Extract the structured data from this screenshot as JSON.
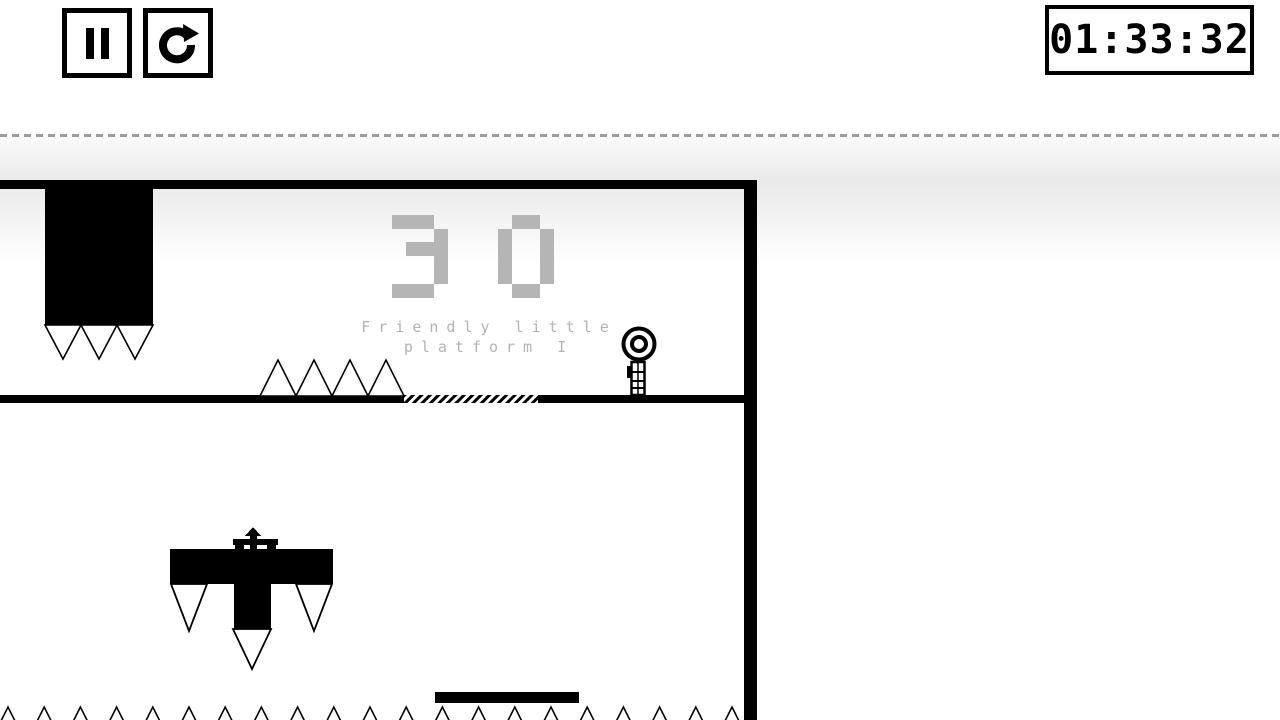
{
  "hud": {
    "timer": {
      "value": "01:33:32"
    },
    "buttons": {
      "pause": {
        "icon": "pause-icon"
      },
      "restart": {
        "icon": "restart-icon"
      }
    }
  },
  "level": {
    "number": "30",
    "name_line1": "Friendly little",
    "name_line2": "platform I"
  },
  "colors": {
    "ink": "#000000",
    "level_text_gray": "#b5b5b5",
    "dash_gray": "#9b9b9b",
    "band_gray": "#e9e9e9",
    "background": "#ffffff"
  }
}
